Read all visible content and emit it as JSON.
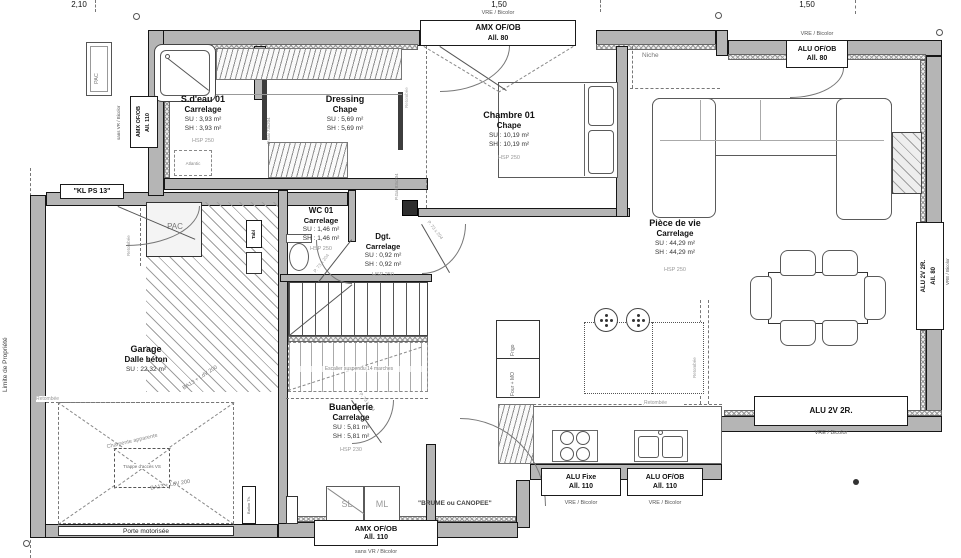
{
  "dimensions": {
    "top_left": "2,10",
    "top_center": "1,50",
    "top_right": "1,50"
  },
  "boundary_label": "Limite de Propriété",
  "rooms": {
    "sdeau": {
      "name": "S.d'eau 01",
      "floor": "Carrelage",
      "su": "SU : 3,93 m²",
      "sh": "SH : 3,93 m²",
      "hsp": "HSP 250"
    },
    "dressing": {
      "name": "Dressing",
      "floor": "Chape",
      "su": "SU : 5,69 m²",
      "sh": "SH : 5,69 m²"
    },
    "chambre": {
      "name": "Chambre 01",
      "floor": "Chape",
      "su": "SU : 10,19 m²",
      "sh": "SH : 10,19 m²",
      "hsp": "HSP 250"
    },
    "piece": {
      "name": "Pièce de vie",
      "floor": "Carrelage",
      "su": "SU : 44,29 m²",
      "sh": "SH : 44,29 m²",
      "hsp": "HSP 250"
    },
    "wc": {
      "name": "WC 01",
      "floor": "Carrelage",
      "su": "SU : 1,46 m²",
      "sh": "SH : 1,46 m²",
      "hsp": "HSP 250"
    },
    "dgt": {
      "name": "Dgt.",
      "floor": "Carrelage",
      "su": "SU : 0,92 m²",
      "sh": "SH : 0,92 m²",
      "hsp": "HSP 250"
    },
    "garage": {
      "name": "Garage",
      "floor": "Dalle béton",
      "su": "SU : 22,32 m²",
      "construction": "BA13 + LdV 200"
    },
    "buanderie": {
      "name": "Buanderie",
      "floor": "Carrelage",
      "su": "SU : 5,81 m²",
      "sh": "SH : 5,81 m²",
      "hsp": "HSP 230"
    }
  },
  "openings": {
    "top_window": {
      "l1": "AMX OF/OB",
      "l2": "All. 80",
      "note": "VRE / Bicolor"
    },
    "top_right_window": {
      "l1": "ALU OF/OB",
      "l2": "All. 80",
      "note": "VRE / Bicolor"
    },
    "left_window": {
      "l1": "AMX OF/OB",
      "l2": "All. 110",
      "note": "sans VR / Bicolor"
    },
    "right_window": {
      "l1": "ALU 2V 2R.",
      "l2": "All. 80",
      "note": "VRE / Bicolor"
    },
    "bay": {
      "l1": "ALU 2V 2R.",
      "note": "VRE / Bicolor"
    },
    "kitchen_fixed": {
      "l1": "ALU Fixe",
      "l2": "All. 110",
      "note": "VRE / Bicolor"
    },
    "kitchen_ofob": {
      "l1": "ALU OF/OB",
      "l2": "All. 110",
      "note": "VRE / Bicolor"
    },
    "laundry_window": {
      "l1": "AMX OF/OB",
      "l2": "All. 110",
      "note": "sans VR / Bicolor"
    },
    "entry_door": "\"KL PS 13\"",
    "garage_door": "Porte motorisée",
    "pocket_dressing": "P.Gal 73x204",
    "pocket_hall": "P.Gal 83x204",
    "swing_door": "P. 73 x 204"
  },
  "annotations": {
    "niche": "Niche",
    "pac": "PAC",
    "tabl": "Tabl",
    "atlantic": "Atlantic",
    "sl": "SL",
    "ml": "ML",
    "frigo": "Frigo",
    "four_mo": "Four + MO",
    "retombee": "Retombée",
    "charpente": "Charpente apparente",
    "trappe": "Trappe d'accès VS",
    "brume": "\"BRUME ou CANOPEE\"",
    "stairs": "Escalier suspendu 14 marches",
    "ballon": "Ballon Th."
  }
}
